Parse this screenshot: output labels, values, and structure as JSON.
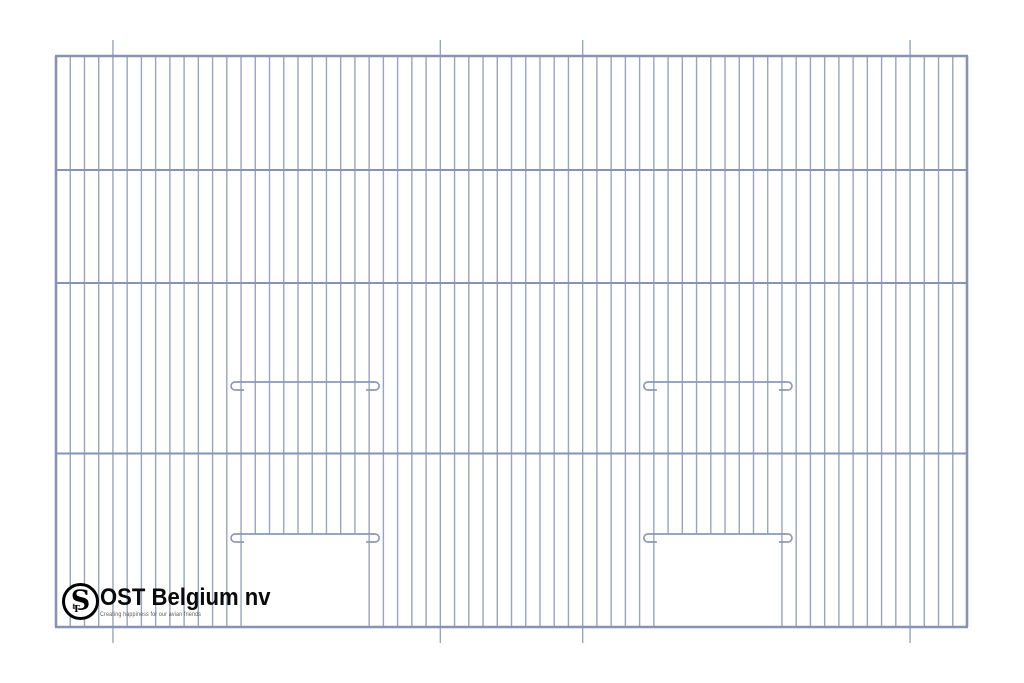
{
  "drawing": {
    "background_color": "#ffffff",
    "panel": {
      "left": 56,
      "top": 56,
      "right": 967,
      "bottom": 627
    },
    "grid": {
      "gap_count": 64,
      "vertical_wire_width": 1.4,
      "horizontal_wire_width": 2,
      "frame_width": 2.6,
      "door_bar_width": 1.7
    },
    "colors": {
      "vertical_wire": "#9AA4BE",
      "horizontal_wire": "#8793B2",
      "frame": "#8793B2",
      "door_bar": "#8C99B8"
    },
    "horizontal_wires_y": [
      170,
      283,
      453.5
    ],
    "extended_wires": {
      "indices": [
        4,
        27,
        37,
        60
      ],
      "extension_px": 16
    },
    "doors": [
      {
        "left_wire_index": 13,
        "right_wire_index": 22,
        "latch_bar_y": 382,
        "opening_top_y": 534
      },
      {
        "left_wire_index": 42,
        "right_wire_index": 51,
        "latch_bar_y": 382,
        "opening_top_y": 534
      }
    ],
    "hook": {
      "reach_px": 10,
      "drop_px": 8,
      "radius_px": 4
    }
  },
  "logo": {
    "monogram_s": "S",
    "monogram_t": "T",
    "company_name": "OST Belgium nv",
    "tagline": "Creating happiness for our avian friends",
    "name_color": "#0a0a0a",
    "tagline_color": "#5c5c5c",
    "ring_color": "#000000"
  }
}
